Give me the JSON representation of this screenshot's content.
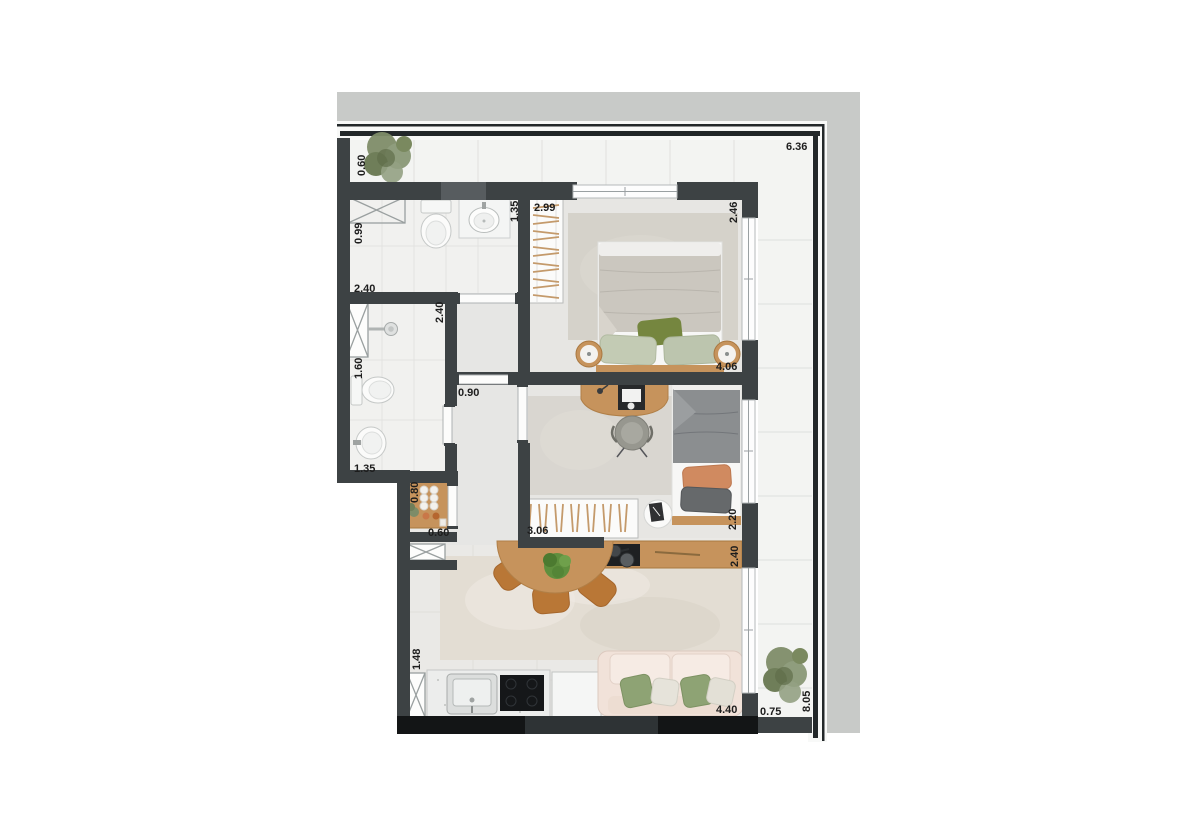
{
  "labels": {
    "terrace_depth_top": "0.60",
    "terrace_length_top": "6.36",
    "bath1_left": "0.99",
    "bath1_width": "2.40",
    "bath1_right": "1.35",
    "closet1_width": "2.99",
    "bedroom1_depth": "2.46",
    "hall_top": "2.40",
    "bath2_left": "1.60",
    "hall_width": "0.90",
    "bedroom1_width": "4.06",
    "bath2_bottom": "1.35",
    "entry_console": "0.80",
    "entry_width": "0.60",
    "closet2_width": "3.06",
    "bedroom2_depth": "2.20",
    "kitchen_island": "2.40",
    "kitchen_left": "1.48",
    "living_width": "4.40",
    "terrace_depth_bottom": "0.75",
    "terrace_length_right": "8.05"
  },
  "colors": {
    "wall": "#3d4244",
    "wall_dark": "#131516",
    "wall_light_segment": "#575c5f",
    "concrete": "#c8cac8",
    "terrace_tile": "#f3f4f2",
    "floor_light": "#eae9e6",
    "floor_bath": "#f1f1ef",
    "floor_bedroom": "#e7e6e3",
    "floor_hall": "#e6e6e4",
    "rug_bedroom": "#d5d2ca",
    "rug_bedroom2": "#d9d6d0",
    "rug_living": "#e3ddd3",
    "wood": "#c6935c",
    "chair_wood": "#b97736",
    "sofa": "#f1e2d9",
    "pillow_green": "#8ea374",
    "pillow_olive": "#75863f",
    "pillow_orange": "#d08a60",
    "duvet_gray": "#8b8e90",
    "duvet_beige": "#cbc7bf",
    "plant": "#7e8c68",
    "label_text": "#1d1d1d"
  }
}
